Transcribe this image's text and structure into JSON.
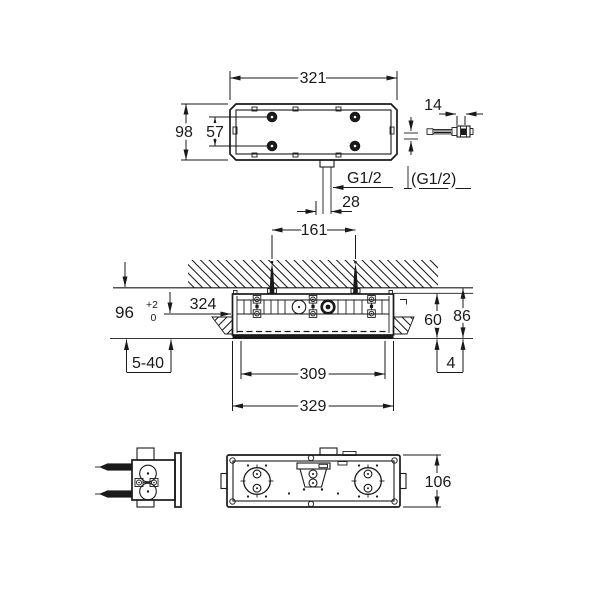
{
  "drawing": {
    "colors": {
      "line": "#1a1a1a",
      "background": "#ffffff"
    },
    "top_view": {
      "width": "321",
      "height": "98",
      "hole_spacing": "57",
      "outlet_thread": "G1/2",
      "outlet_offset": "28"
    },
    "fitting_detail": {
      "length": "14",
      "thread": "(G1/2)"
    },
    "section_view": {
      "screw_spacing": "161",
      "depth": "96",
      "depth_tol_plus": "+2",
      "depth_tol_minus": "0",
      "front_offset": "324",
      "finish_thickness_range": "5-40",
      "height_inner": "60",
      "height_outer": "86",
      "lip": "4",
      "width_inner": "309",
      "width_outer": "329"
    },
    "front_view": {
      "height": "106"
    }
  }
}
